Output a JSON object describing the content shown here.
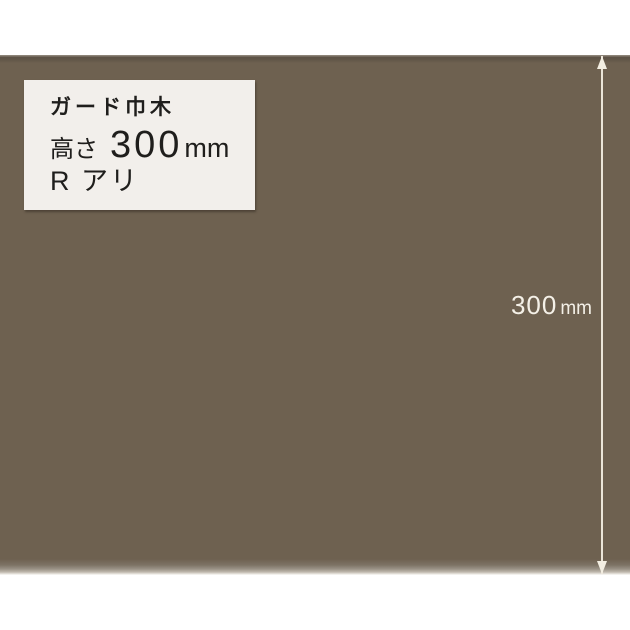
{
  "label_box": {
    "product_name": "ガード巾木",
    "height_label": "高さ",
    "height_value": "300",
    "height_unit": "mm",
    "r_note": "R アリ"
  },
  "dimension": {
    "value": "300",
    "unit": "mm"
  },
  "colors": {
    "material_brown": "#6e6150",
    "material_top_edge_dark": "#5d5245",
    "material_top_edge_light": "#8d8478",
    "material_bottom_fade": "#e9e6e0",
    "label_box_background": "#f2efeb",
    "label_text": "#1f1e1c",
    "dimension_annotation": "#f3eee2",
    "page_background": "#ffffff"
  }
}
